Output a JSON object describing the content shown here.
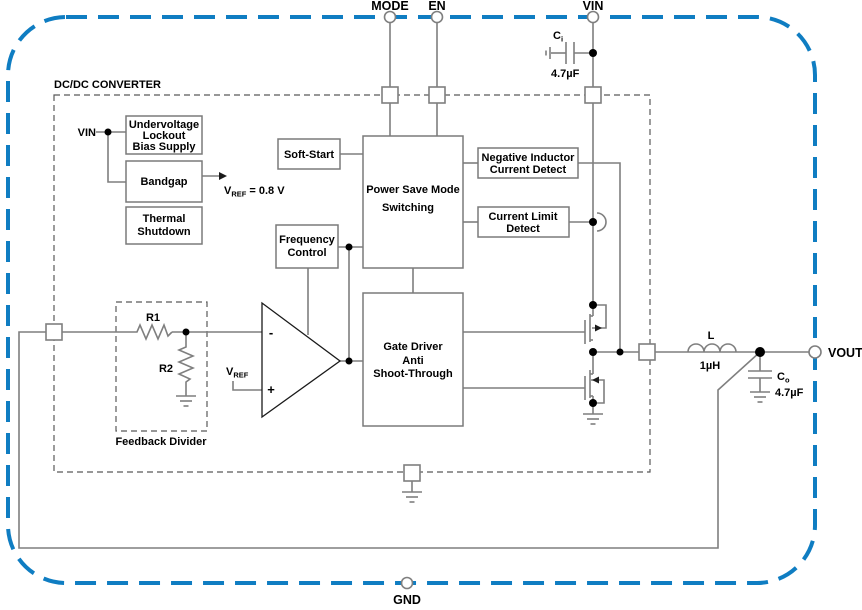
{
  "diagram": {
    "title": "DC/DC CONVERTER",
    "pins": {
      "mode": "MODE",
      "en": "EN",
      "vin": "VIN",
      "vout": "VOUT",
      "gnd": "GND"
    },
    "blocks": {
      "uvlo": {
        "l1": "Undervoltage",
        "l2": "Lockout",
        "l3": "Bias Supply"
      },
      "bandgap": {
        "l1": "Bandgap"
      },
      "thermal": {
        "l1": "Thermal",
        "l2": "Shutdown"
      },
      "softstart": {
        "l1": "Soft-Start"
      },
      "psm": {
        "l1": "Power Save Mode",
        "l2": "Switching"
      },
      "freq": {
        "l1": "Frequency",
        "l2": "Control"
      },
      "nicd": {
        "l1": "Negative Inductor",
        "l2": "Current Detect"
      },
      "cld": {
        "l1": "Current Limit",
        "l2": "Detect"
      },
      "gate": {
        "l1": "Gate Driver",
        "l2": "Anti",
        "l3": "Shoot-Through"
      },
      "fbdiv": {
        "label": "Feedback Divider"
      }
    },
    "labels": {
      "vin_internal": "VIN",
      "vref_v": "V",
      "vref_sub": "REF",
      "vref_eq": " = 0.8 V",
      "vrefp_v": "V",
      "vrefp_sub": "REF",
      "minus": "-",
      "plus": "+",
      "r1": "R1",
      "r2": "R2",
      "ci_c": "C",
      "ci_sub": "i",
      "ci_val": "4.7µF",
      "co_c": "C",
      "co_sub": "o",
      "co_val": "4.7µF",
      "ind": "L",
      "ind_val": "1µH"
    },
    "colors": {
      "boundary": "#0f7dc2",
      "wire": "#7f7f7f",
      "text": "#000000"
    }
  }
}
